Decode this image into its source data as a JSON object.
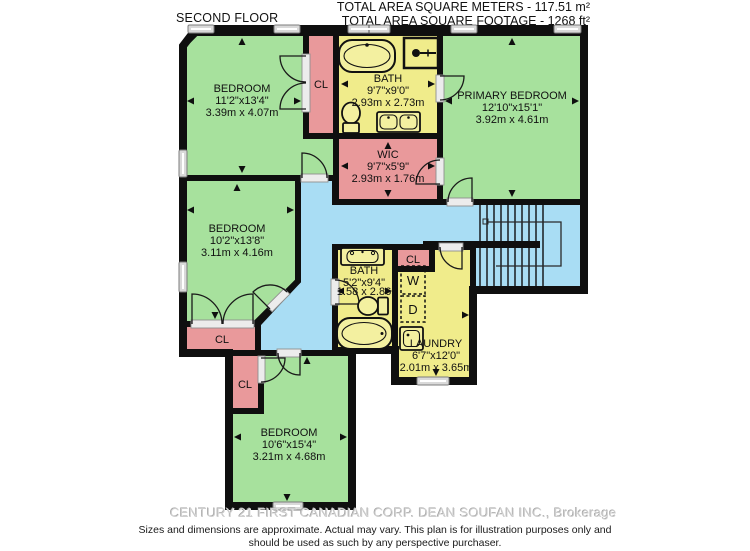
{
  "header": {
    "floor_label": "SECOND FLOOR",
    "area_line1": "TOTAL AREA SQUARE METERS - 117.51 m²",
    "area_line2": "TOTAL AREA SQUARE FOOTAGE - 1268 ft²"
  },
  "rooms": {
    "bedroom_top_left": {
      "name": "BEDROOM",
      "dim_imperial": "11'2\"x13'4\"",
      "dim_metric": "3.39m x 4.07m"
    },
    "bath_main": {
      "name": "BATH",
      "dim_imperial": "9'7\"x9'0\"",
      "dim_metric": "2.93m x 2.73m"
    },
    "primary_bedroom": {
      "name": "PRIMARY BEDROOM",
      "dim_imperial": "12'10\"x15'1\"",
      "dim_metric": "3.92m x 4.61m"
    },
    "wic": {
      "name": "WIC",
      "dim_imperial": "9'7\"x5'9\"",
      "dim_metric": "2.93m x 1.76m"
    },
    "bedroom_mid_left": {
      "name": "BEDROOM",
      "dim_imperial": "10'2\"x13'8\"",
      "dim_metric": "3.11m x 4.16m"
    },
    "bath_second": {
      "name": "BATH",
      "dim_imperial": "5'2\"x9'4\"",
      "dim_metric": "1.58 x 2.86"
    },
    "laundry": {
      "name": "LAUNDRY",
      "dim_imperial": "6'7\"x12'0\"",
      "dim_metric": "2.01m x 3.65m"
    },
    "bedroom_bottom": {
      "name": "BEDROOM",
      "dim_imperial": "10'6\"x15'4\"",
      "dim_metric": "3.21m x 4.68m"
    }
  },
  "labels": {
    "closet": "CL",
    "washer": "W",
    "dryer": "D"
  },
  "footer": {
    "watermark": "CENTURY 21 FIRST CANADIAN CORP. DEAN SOUFAN INC., Brokerage",
    "disclaimer_line1": "Sizes and dimensions are approximate. Actual may vary. This plan is for illustration purposes only and",
    "disclaimer_line2": "should be used as such by any perspective purchaser."
  },
  "colors": {
    "bedroom_green": "#a7e19d",
    "closet_pink": "#e9999b",
    "bath_yellow": "#f0ec8b",
    "hall_blue": "#a9ddf4",
    "wall_black": "#0f0f0f",
    "window_gray": "#d9d9d9",
    "fixture_fill": "#f3f0a0"
  }
}
